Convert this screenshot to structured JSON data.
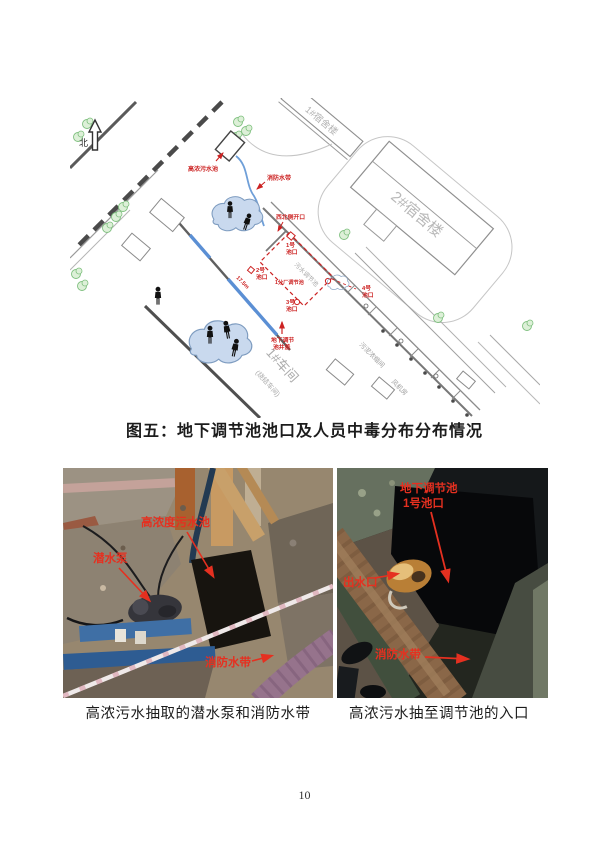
{
  "page": {
    "number": "10"
  },
  "figure": {
    "caption": "图五：地下调节池池口及人员中毒分布分布情况"
  },
  "diagram": {
    "north": "北",
    "dorm1": "1#宿舍楼",
    "dorm2": "2#宿舍楼",
    "workshop1": "1#车间",
    "workshop2": "(烧结车间)",
    "sludge_room": "污泥浓缩间",
    "fan_room": "风机房",
    "road_pool": "污水调节池",
    "sewage_pool": "高浓污水池",
    "fire_hose": "消防水带",
    "nw_opening": "西北侧开口",
    "pool1a": "1号",
    "pool1b": "池口",
    "pool2a": "2号",
    "pool2b": "池口",
    "pool3a": "3号",
    "pool3b": "池口",
    "pool4a": "4号",
    "pool4b": "池口",
    "center_pool": "1分厂调节池",
    "distance": "17.5m",
    "manhole1": "地下调节",
    "manhole2": "池井盖"
  },
  "photo_left": {
    "caption": "高浓污水抽取的潜水泵和消防水带",
    "ann_pit": "高浓度污水池",
    "ann_pump": "潜水泵",
    "ann_hose": "消防水带"
  },
  "photo_right": {
    "caption": "高浓污水抽至调节池的入口",
    "ann_pool_l1": "地下调节池",
    "ann_pool_l2": "1号池口",
    "ann_outlet": "出水口",
    "ann_hose": "消防水带"
  },
  "colors": {
    "annotation_red": "#cc2222",
    "photo_red": "#e53020",
    "cloud_blue": "#c9d9ee"
  }
}
